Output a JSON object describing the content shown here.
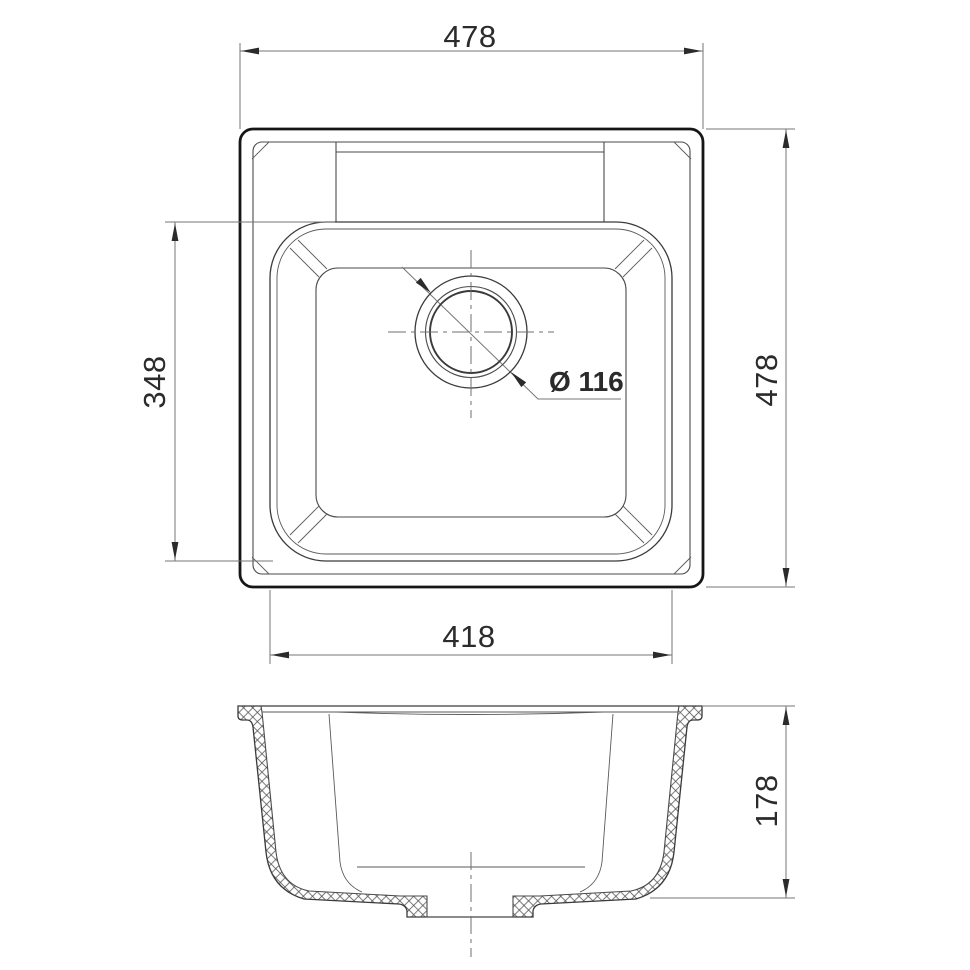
{
  "drawing": {
    "kind": "sink-technical-drawing",
    "views": {
      "plan": {
        "name": "plan-view"
      },
      "section": {
        "name": "section-view"
      }
    },
    "dimensions": {
      "overall_width": "478",
      "overall_depth": "478",
      "bowl_depth": "348",
      "bowl_width": "418",
      "overall_height": "178",
      "drain_diameter": "Ø 116"
    },
    "colors": {
      "background": "#ffffff",
      "outline": "#161616",
      "line": "#3a3a3a",
      "dimension": "#757575",
      "text": "#2b2b2b"
    }
  }
}
